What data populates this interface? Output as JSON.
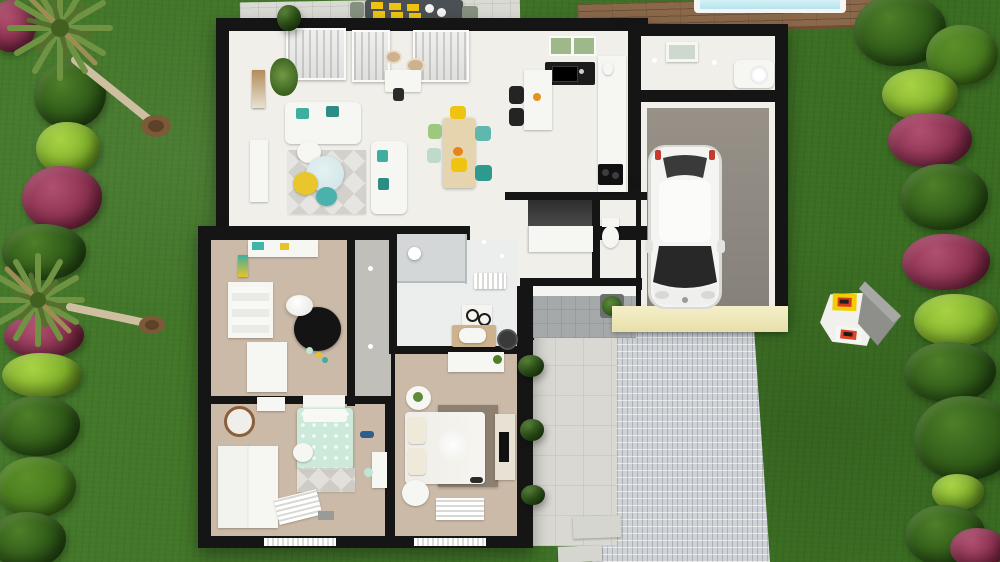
{
  "scene": {
    "title": "3D aerial floor plan render - single-storey house with garden, garage and pool deck",
    "palette": {
      "grass": "#3e7424",
      "wall": "#151515",
      "floor_white": "#f1efe9",
      "floor_beige": "#ccbaa8",
      "floor_gray": "#c1bfba",
      "floor_bath": "#eceeee",
      "garage_floor": "#8d8780",
      "porch": "#a6a9aa",
      "driveway": "#cfd3d7",
      "walkway": "#d9d8d2",
      "deck_wood": "#8b684a",
      "pool_water": "#c7ebf3",
      "cream_facade": "#f1ebc2",
      "accent_yellow": "#eec411",
      "accent_teal": "#3fae9f",
      "accent_mint": "#cde9d9",
      "rug_black": "#141414",
      "rug_taupe": "#8d8071",
      "wood_table": "#e5d4ad",
      "car_body": "#f4f4f2",
      "glass_dark": "#282828"
    },
    "bush_colors": {
      "dark": [
        "#4e7f28",
        "#2f5a18",
        "#16320b"
      ],
      "mid": [
        "#5c8f28",
        "#477a1e",
        "#24420e"
      ],
      "light": [
        "#a8d244",
        "#82b32c",
        "#4c7315"
      ],
      "magenta": [
        "#b05070",
        "#8c3150",
        "#551328"
      ]
    },
    "vegetation": {
      "left": [
        {
          "x": 12,
          "y": 26,
          "rx": 24,
          "ry": 26,
          "c": "magenta"
        },
        {
          "x": 70,
          "y": 95,
          "rx": 36,
          "ry": 33,
          "c": "dark"
        },
        {
          "x": 68,
          "y": 148,
          "rx": 32,
          "ry": 26,
          "c": "light"
        },
        {
          "x": 62,
          "y": 198,
          "rx": 40,
          "ry": 32,
          "c": "magenta"
        },
        {
          "x": 44,
          "y": 252,
          "rx": 42,
          "ry": 28,
          "c": "dark"
        },
        {
          "x": 44,
          "y": 336,
          "rx": 40,
          "ry": 22,
          "c": "magenta"
        },
        {
          "x": 42,
          "y": 375,
          "rx": 40,
          "ry": 22,
          "c": "light"
        },
        {
          "x": 38,
          "y": 426,
          "rx": 42,
          "ry": 30,
          "c": "dark"
        },
        {
          "x": 36,
          "y": 487,
          "rx": 40,
          "ry": 30,
          "c": "mid"
        },
        {
          "x": 28,
          "y": 540,
          "rx": 38,
          "ry": 28,
          "c": "dark"
        }
      ],
      "right": [
        {
          "x": 900,
          "y": 30,
          "rx": 46,
          "ry": 36,
          "c": "dark"
        },
        {
          "x": 962,
          "y": 55,
          "rx": 36,
          "ry": 30,
          "c": "mid"
        },
        {
          "x": 920,
          "y": 94,
          "rx": 38,
          "ry": 25,
          "c": "light"
        },
        {
          "x": 930,
          "y": 140,
          "rx": 42,
          "ry": 27,
          "c": "magenta"
        },
        {
          "x": 944,
          "y": 197,
          "rx": 44,
          "ry": 33,
          "c": "dark"
        },
        {
          "x": 946,
          "y": 262,
          "rx": 44,
          "ry": 28,
          "c": "magenta"
        },
        {
          "x": 956,
          "y": 320,
          "rx": 42,
          "ry": 26,
          "c": "light"
        },
        {
          "x": 950,
          "y": 372,
          "rx": 46,
          "ry": 30,
          "c": "dark"
        },
        {
          "x": 966,
          "y": 438,
          "rx": 52,
          "ry": 42,
          "c": "dark"
        },
        {
          "x": 958,
          "y": 492,
          "rx": 26,
          "ry": 18,
          "c": "light"
        },
        {
          "x": 945,
          "y": 535,
          "rx": 40,
          "ry": 30,
          "c": "dark"
        },
        {
          "x": 978,
          "y": 548,
          "rx": 28,
          "ry": 20,
          "c": "magenta"
        }
      ],
      "extra": [
        {
          "x": 289,
          "y": 18,
          "rx": 12,
          "ry": 13,
          "c": "dark"
        },
        {
          "x": 531,
          "y": 366,
          "rx": 13,
          "ry": 11,
          "c": "dark"
        },
        {
          "x": 532,
          "y": 430,
          "rx": 12,
          "ry": 11,
          "c": "dark"
        },
        {
          "x": 533,
          "y": 495,
          "rx": 12,
          "ry": 10,
          "c": "dark"
        }
      ]
    },
    "walls": {
      "blocks": [
        {
          "x": 216,
          "y": 18,
          "w": 432,
          "h": 220
        },
        {
          "x": 628,
          "y": 24,
          "w": 160,
          "h": 298
        },
        {
          "x": 515,
          "y": 188,
          "w": 133,
          "h": 102
        },
        {
          "x": 198,
          "y": 226,
          "w": 335,
          "h": 322
        }
      ],
      "partitions": [
        {
          "x": 198,
          "y": 226,
          "w": 450,
          "h": 14
        },
        {
          "x": 347,
          "y": 230,
          "w": 8,
          "h": 176
        },
        {
          "x": 389,
          "y": 230,
          "w": 8,
          "h": 122
        },
        {
          "x": 389,
          "y": 346,
          "w": 128,
          "h": 8
        },
        {
          "x": 203,
          "y": 396,
          "w": 190,
          "h": 8
        },
        {
          "x": 385,
          "y": 402,
          "w": 10,
          "h": 134
        },
        {
          "x": 505,
          "y": 192,
          "w": 143,
          "h": 8
        },
        {
          "x": 592,
          "y": 198,
          "w": 8,
          "h": 88
        },
        {
          "x": 641,
          "y": 90,
          "w": 134,
          "h": 12
        },
        {
          "x": 520,
          "y": 278,
          "w": 122,
          "h": 12
        },
        {
          "x": 526,
          "y": 286,
          "w": 8,
          "h": 54
        }
      ],
      "openings": [
        {
          "x": 470,
          "y": 226,
          "w": 122,
          "h": 14
        }
      ]
    },
    "rooms": [
      {
        "id": "living-dining",
        "x": 229,
        "y": 31,
        "w": 281,
        "h": 195,
        "floor": "floor_white"
      },
      {
        "id": "kitchen",
        "x": 505,
        "y": 31,
        "w": 123,
        "h": 165,
        "floor": "floor_white"
      },
      {
        "id": "entry-hall",
        "x": 470,
        "y": 200,
        "w": 122,
        "h": 86,
        "floor": "floor_white"
      },
      {
        "id": "wc",
        "x": 598,
        "y": 200,
        "w": 38,
        "h": 80,
        "floor": "floor_white"
      },
      {
        "id": "utility",
        "x": 641,
        "y": 36,
        "w": 134,
        "h": 54,
        "floor": "floor_white"
      },
      {
        "id": "garage",
        "x": 641,
        "y": 102,
        "w": 134,
        "h": 208,
        "floor": "floor_white"
      },
      {
        "id": "hallway",
        "x": 353,
        "y": 238,
        "w": 38,
        "h": 164,
        "floor": "floor_gray"
      },
      {
        "id": "kids-bedroom",
        "x": 211,
        "y": 238,
        "w": 136,
        "h": 160,
        "floor": "floor_beige"
      },
      {
        "id": "bathroom",
        "x": 393,
        "y": 230,
        "w": 124,
        "h": 118,
        "floor": "floor_bath"
      },
      {
        "id": "small-bedroom",
        "x": 211,
        "y": 404,
        "w": 174,
        "h": 132,
        "floor": "floor_beige"
      },
      {
        "id": "master-bedroom",
        "x": 395,
        "y": 352,
        "w": 122,
        "h": 184,
        "floor": "floor_beige"
      }
    ],
    "objects": [
      "palm-tree",
      "bushes",
      "pool",
      "wood-deck",
      "patio-table",
      "outdoor-chairs",
      "sofa",
      "coffee-tables",
      "dining-table",
      "kitchen-island",
      "sink",
      "cooktop",
      "toilet",
      "shower",
      "vanity",
      "beds",
      "wardrobe",
      "round-rug",
      "car",
      "driveway",
      "walkway",
      "stepping-stones",
      "playhouse",
      "plant-pots"
    ]
  }
}
